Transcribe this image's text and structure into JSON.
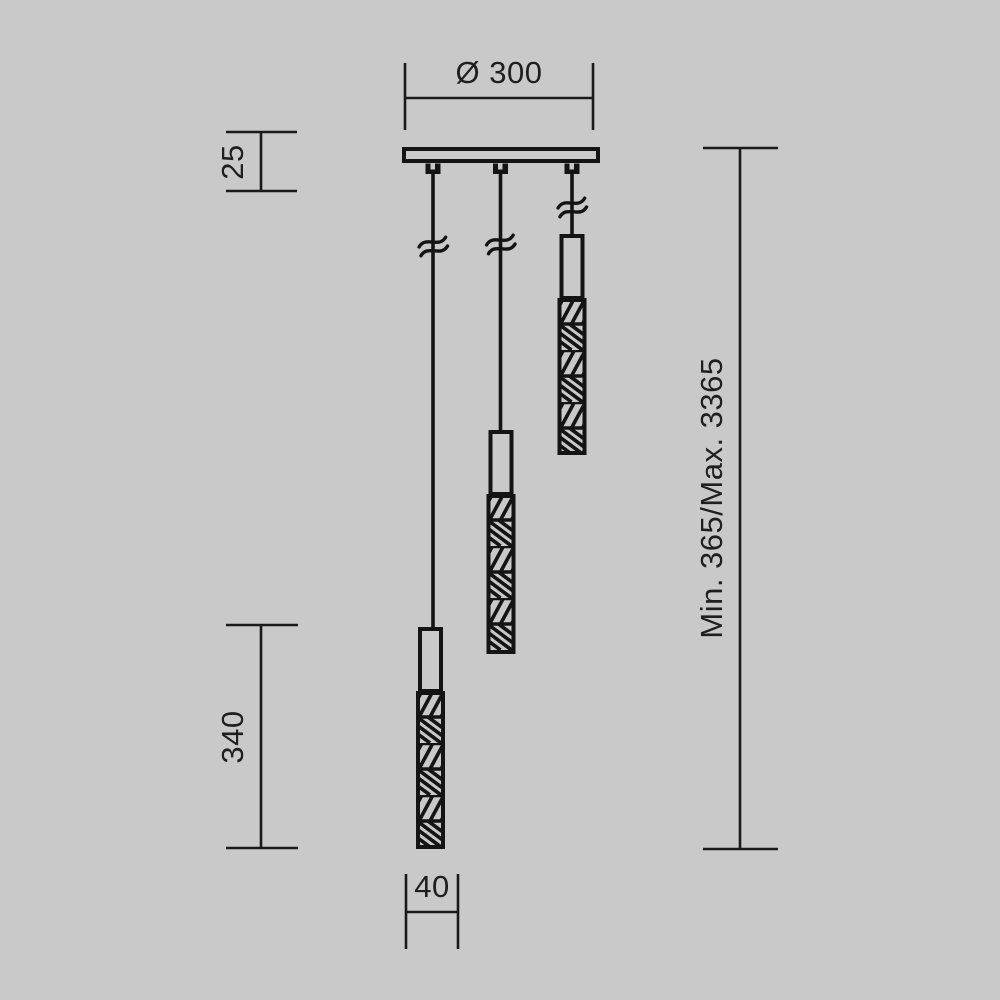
{
  "drawing": {
    "kind": "technical-dimension-drawing",
    "subject": "three-light cascading pendant lamp, front elevation"
  },
  "colors": {
    "background": "#c9c9c9",
    "line": "#141414",
    "text": "#1f1f1f"
  },
  "dims": {
    "canopy_diameter": "Ø 300",
    "canopy_thickness": "25",
    "shade_length": "340",
    "shade_diameter": "40",
    "suspension_range": "Min. 365/Max. 3365"
  }
}
